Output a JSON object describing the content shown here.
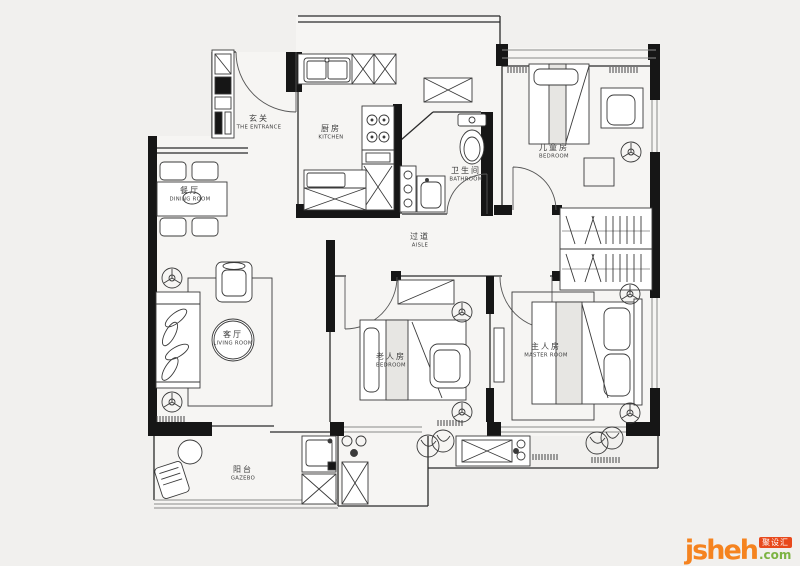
{
  "background": "#f1f0ee",
  "ink": "#1a1a1a",
  "rooms": [
    {
      "id": "entrance",
      "zh": "玄关",
      "en": "THE ENTRANCE"
    },
    {
      "id": "dining-room",
      "zh": "餐厅",
      "en": "DINING ROOM"
    },
    {
      "id": "kitchen",
      "zh": "厨房",
      "en": "KITCHEN"
    },
    {
      "id": "bathroom",
      "zh": "卫生间",
      "en": "BATHROOM"
    },
    {
      "id": "kids-bedroom",
      "zh": "儿童房",
      "en": "BEDROOM"
    },
    {
      "id": "aisle",
      "zh": "过道",
      "en": "AISLE"
    },
    {
      "id": "living-room",
      "zh": "客厅",
      "en": "LIVING ROOM"
    },
    {
      "id": "elder-bedroom",
      "zh": "老人房",
      "en": "BEDROOM"
    },
    {
      "id": "master-bedroom",
      "zh": "主人房",
      "en": "MASTER ROOM"
    },
    {
      "id": "balcony",
      "zh": "阳台",
      "en": "GAZEBO"
    }
  ],
  "watermark": {
    "brand": "jsheh",
    "tld": ".com",
    "badge": "聚设汇",
    "brand_color": "#F5831F",
    "tld_color": "#7CB342",
    "badge_color": "#E8491C"
  }
}
